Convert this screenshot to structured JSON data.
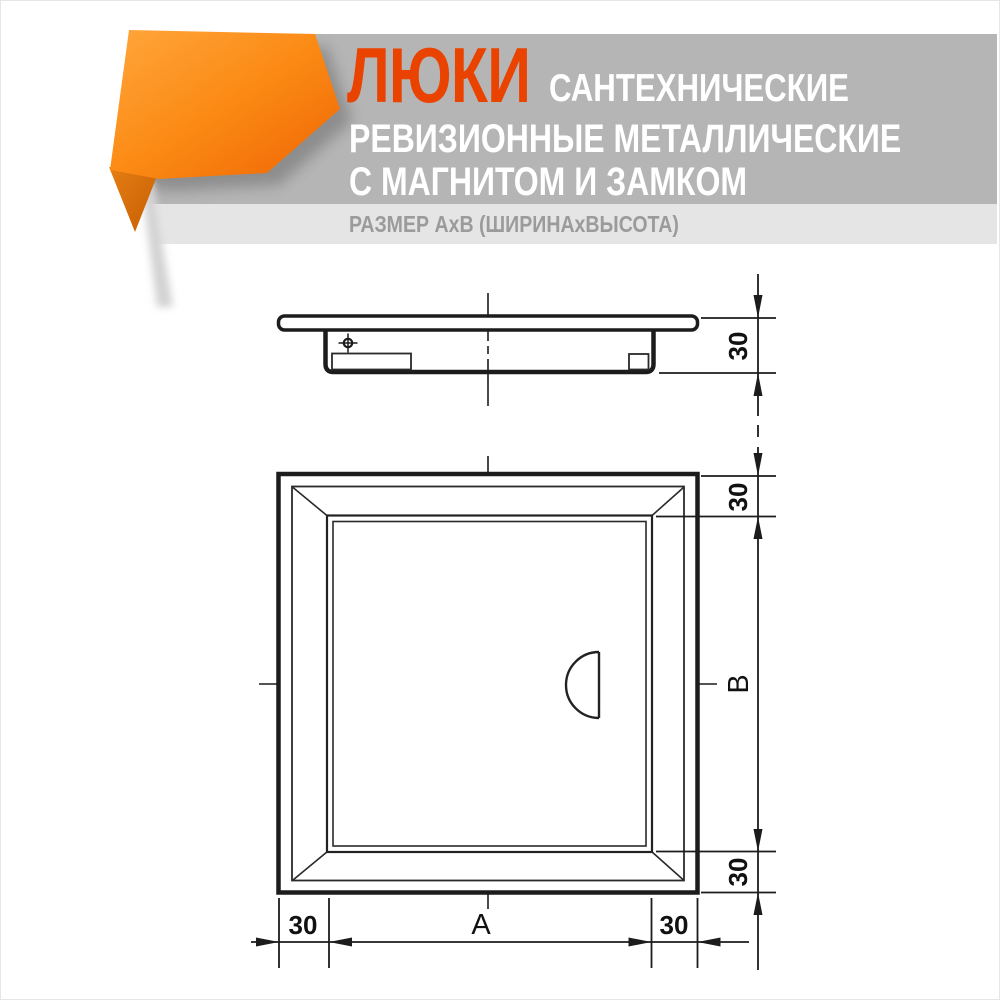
{
  "header": {
    "title_main": "ЛЮКИ",
    "title_tail": "САНТЕХНИЧЕСКИЕ",
    "title_line2": "РЕВИЗИОННЫЕ МЕТАЛЛИЧЕСКИЕ",
    "title_line3": "С МАГНИТОМ И ЗАМКОМ",
    "subtitle": "РАЗМЕР АхВ (ШИРИНАхВЫСОТА)",
    "colors": {
      "accent_title": "#ea4300",
      "band": "#b5b5b5",
      "strip": "#e5e5e5",
      "subtitle_text": "#9b9b9b",
      "ribbon_light": "#ffa63c",
      "ribbon_mid": "#fb8a14",
      "ribbon_dark": "#ef6504",
      "ribbon_fold": "#c75e03"
    }
  },
  "drawing": {
    "line_color": "#1c1c1c",
    "views": {
      "side_view": "люк — вид сбоку (профиль)",
      "front_view": "люк — вид спереди"
    },
    "dimensions": {
      "side_thickness": "30",
      "frame_top": "30",
      "height_label": "В",
      "frame_bottom": "30",
      "frame_left": "30",
      "width_label": "А",
      "frame_right": "30"
    }
  }
}
